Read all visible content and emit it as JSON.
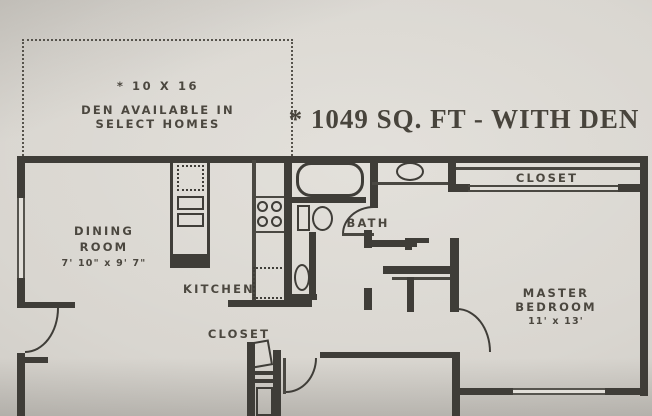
{
  "title": {
    "text": "* 1049 SQ. FT - WITH DEN"
  },
  "den_note": {
    "line1": "* 10 X 16",
    "line2": "DEN AVAILABLE IN",
    "line3": "SELECT HOMES"
  },
  "rooms": {
    "dining": {
      "line1": "DINING",
      "line2": "ROOM",
      "dims": "7' 10\" x 9' 7\""
    },
    "kitchen": {
      "label": "KITCHEN"
    },
    "bath": {
      "label": "BATH"
    },
    "master_closet": {
      "label": "CLOSET"
    },
    "entry_closet": {
      "label": "CLOSET"
    },
    "master_bedroom": {
      "line1": "MASTER",
      "line2": "BEDROOM",
      "dims": "11' x 13'"
    }
  },
  "colors": {
    "wall": "#3f3d38",
    "ink": "#4b473f",
    "paper": "#d9d6d0"
  }
}
